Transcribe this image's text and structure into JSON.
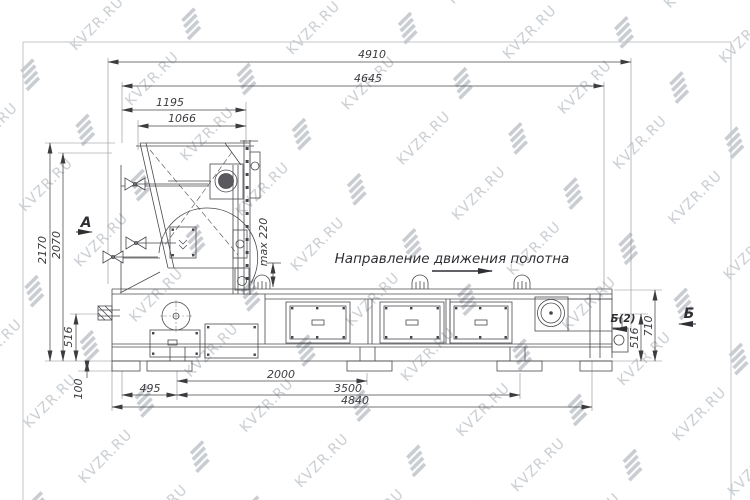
{
  "watermark": {
    "text": "KVZR.RU"
  },
  "annotations": {
    "direction": "Направление движения полотна",
    "view_a": "А",
    "view_b": "Б",
    "view_b2": "Б(2)",
    "max_note": "max 220"
  },
  "dimensions": {
    "top": [
      "4910",
      "4645",
      "1195",
      "1066"
    ],
    "left": [
      "2170",
      "2070",
      "516",
      "100"
    ],
    "right": [
      "710",
      "516"
    ],
    "bottom": [
      "495",
      "2000",
      "3500",
      "4840"
    ]
  },
  "colors": {
    "line": "#4a4a4e",
    "dim": "#55555a",
    "watermark": "#c9cdd1",
    "border": "#c3c6c9"
  }
}
